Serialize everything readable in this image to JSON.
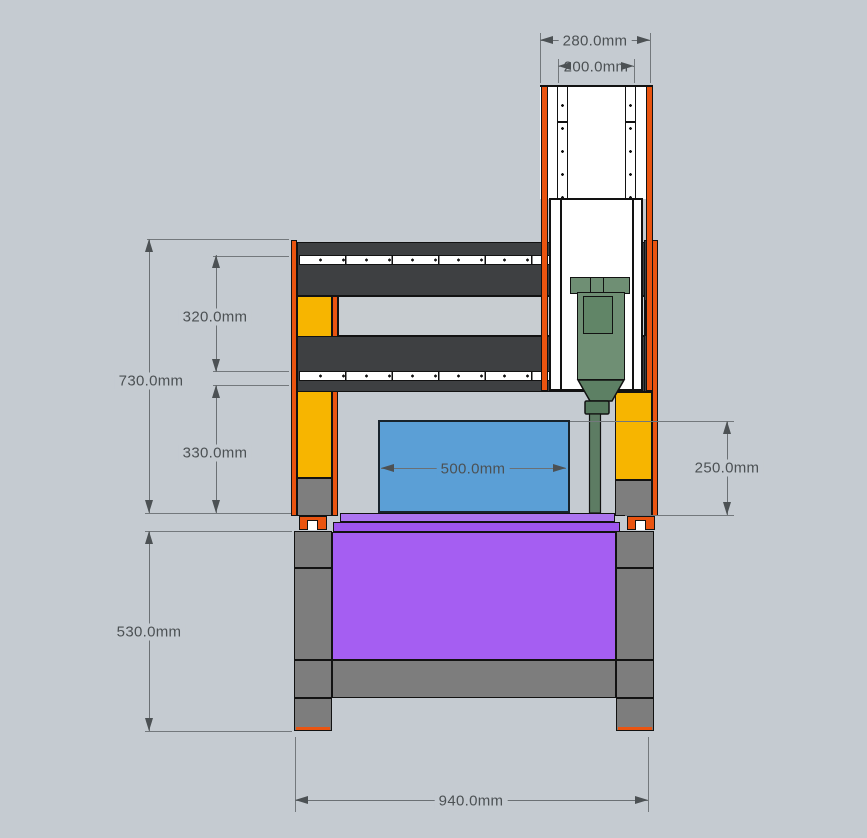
{
  "drawing": {
    "type": "front elevation",
    "subject": "CNC gantry router machine",
    "units": "mm",
    "background_color": "#c5cbd1"
  },
  "dimensions": {
    "d280": {
      "label": "280.0mm"
    },
    "d200": {
      "label": "200.0mm"
    },
    "d320": {
      "label": "320.0mm"
    },
    "d730": {
      "label": "730.0mm"
    },
    "d330": {
      "label": "330.0mm"
    },
    "d500": {
      "label": "500.0mm"
    },
    "d250": {
      "label": "250.0mm"
    },
    "d530": {
      "label": "530.0mm"
    },
    "d940": {
      "label": "940.0mm"
    }
  },
  "parts": {
    "gantry_beams": {
      "color": "#3e4042"
    },
    "linear_rails": {
      "color": "#ffffff"
    },
    "columns": {
      "color": "#f7b500"
    },
    "frame_edges": {
      "color": "#ea5410"
    },
    "spindle": {
      "color": "#6f8f74"
    },
    "workpiece": {
      "color": "#5b9fd6"
    },
    "table": {
      "color": "#a55ef2"
    },
    "stand_legs": {
      "color": "#7d7d7d"
    },
    "dimension_lines": {
      "color": "#73787c"
    },
    "dimension_text": {
      "color": "#4c5154"
    }
  }
}
